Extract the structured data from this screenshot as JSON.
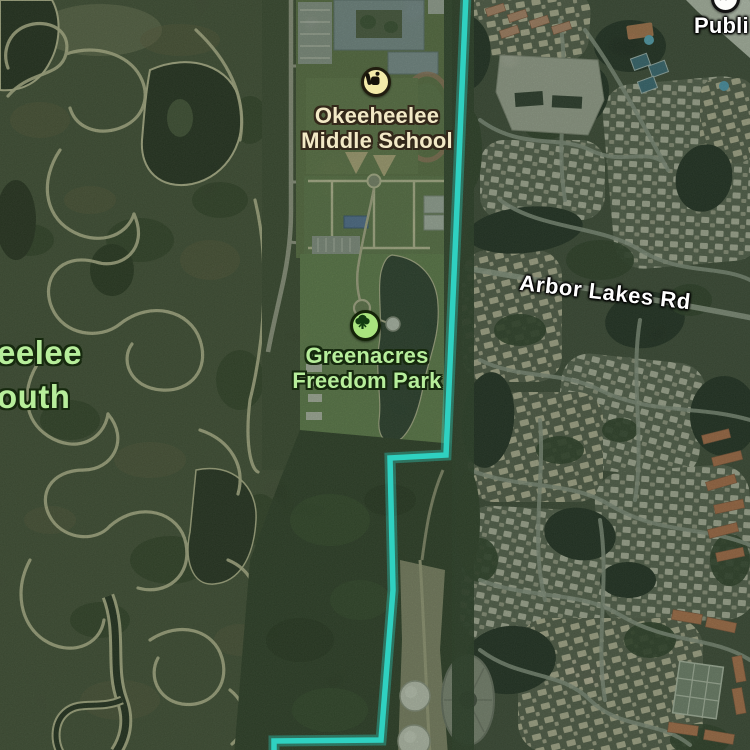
{
  "app": {
    "name": "maps-satellite-view",
    "view_mode": "satellite"
  },
  "map": {
    "boundary": {
      "name": "municipal-boundary-line",
      "color": "#2fd6c6"
    },
    "pois": [
      {
        "id": "okeeheelee-middle-school",
        "label_line1": "Okeeheelee",
        "label_line2": "Middle School",
        "icon": "backpack-school-icon",
        "icon_bg": "#f4eba9",
        "label_color": "#f2e9c6"
      },
      {
        "id": "greenacres-freedom-park",
        "label_line1": "Greenacres",
        "label_line2": "Freedom Park",
        "icon": "tree-park-icon",
        "icon_bg": "#a9e57e",
        "label_color": "#b7ee9b"
      },
      {
        "id": "publix-partial",
        "label": "Publi",
        "icon": "shopping-cart-icon",
        "icon_bg": "#ffffff",
        "label_color": "#ffffff"
      }
    ],
    "area_labels": [
      {
        "id": "okeeheelee-south-partial",
        "line1": "eelee",
        "line2": "outh",
        "color": "#b7ee9b"
      }
    ],
    "road_labels": [
      {
        "id": "arbor-lakes-rd",
        "text": "Arbor Lakes Rd",
        "color": "#ffffff"
      }
    ]
  }
}
